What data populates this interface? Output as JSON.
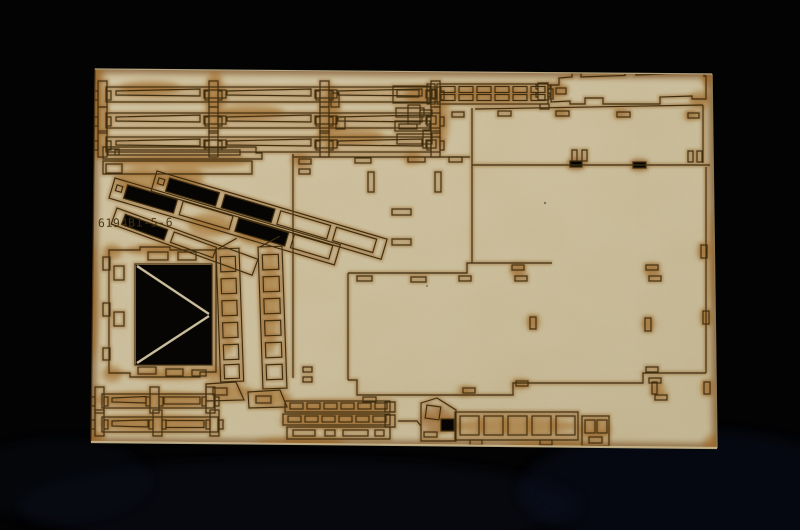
{
  "photo": {
    "subject": "laser-cut model kit sheet",
    "part_number": "6194B1-5-6",
    "colors": {
      "background": "#030304",
      "background_blue_sheen": "#131a30",
      "sheet": "#cfc2a0",
      "sheet_light": "#d8cbaa",
      "sheet_dark": "#c2b595",
      "scorch": "#90591b",
      "burn_heavy": "#6b3a0e",
      "cut_line": "#3e2d0f",
      "hole_black": "#070503",
      "etched_text": "#43300f"
    }
  }
}
